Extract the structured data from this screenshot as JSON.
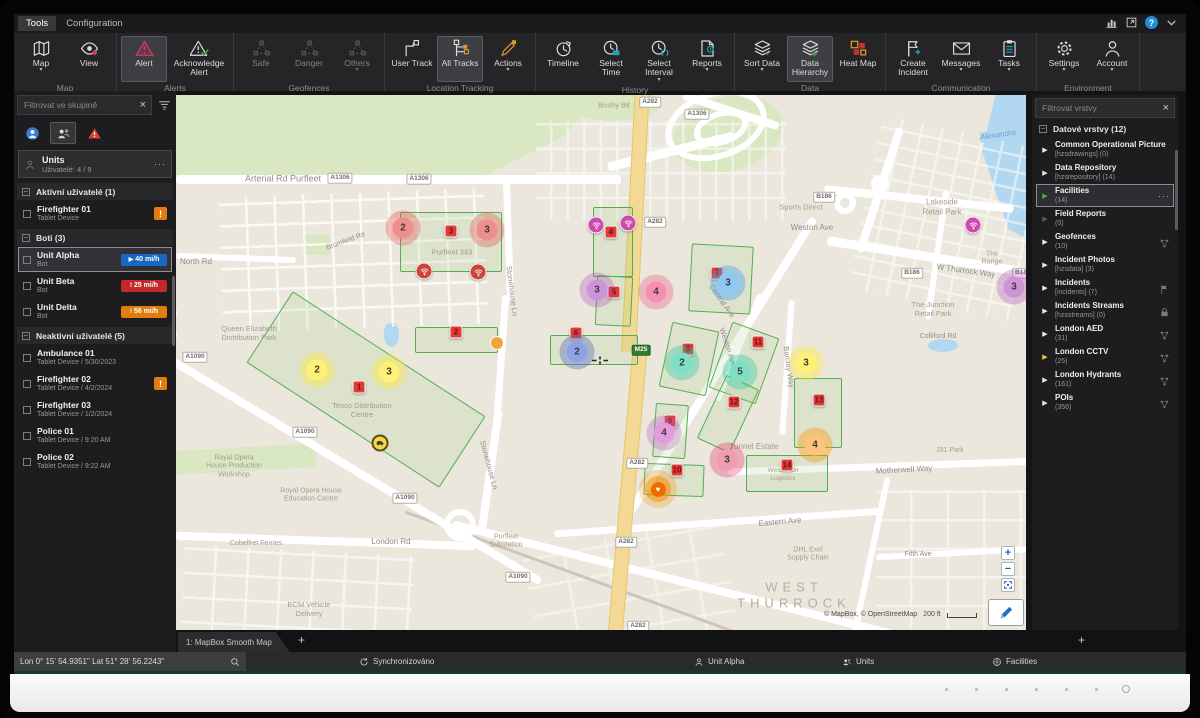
{
  "menubar": {
    "items": [
      {
        "label": "Tools",
        "active": true
      },
      {
        "label": "Configuration",
        "active": false
      }
    ]
  },
  "window_icons": [
    {
      "name": "stats-icon"
    },
    {
      "name": "window-popout-icon"
    },
    {
      "name": "help-icon",
      "glyph": "?"
    },
    {
      "name": "chevron-down-icon"
    }
  ],
  "ribbon": {
    "groups": [
      {
        "label": "Map",
        "buttons": [
          {
            "label": "Map",
            "icon": "map",
            "caret": true
          },
          {
            "label": "View",
            "icon": "view"
          }
        ]
      },
      {
        "label": "Alerts",
        "buttons": [
          {
            "label": "Alert",
            "icon": "alert",
            "active": true
          },
          {
            "label": "Acknowledge Alert",
            "icon": "ack",
            "wide": true
          }
        ]
      },
      {
        "label": "Geofences",
        "buttons": [
          {
            "label": "Safe",
            "icon": "geonet",
            "dim": true
          },
          {
            "label": "Danger",
            "icon": "geonet",
            "dim": true
          },
          {
            "label": "Others",
            "icon": "geonet",
            "dim": true,
            "caret": true
          }
        ]
      },
      {
        "label": "Location Tracking",
        "buttons": [
          {
            "label": "User Track",
            "icon": "usertrack"
          },
          {
            "label": "All Tracks",
            "icon": "alltracks",
            "active": true
          },
          {
            "label": "Actions",
            "icon": "actions",
            "caret": true
          }
        ]
      },
      {
        "label": "History",
        "buttons": [
          {
            "label": "Timeline",
            "icon": "timeline"
          },
          {
            "label": "Select Time",
            "icon": "selecttime"
          },
          {
            "label": "Select Interval",
            "icon": "selectinterval",
            "caret": true
          },
          {
            "label": "Reports",
            "icon": "reports",
            "caret": true
          }
        ]
      },
      {
        "label": "Data",
        "buttons": [
          {
            "label": "Sort Data",
            "icon": "sortdata",
            "caret": true
          },
          {
            "label": "Data Hierarchy",
            "icon": "hierarchy",
            "active": true
          },
          {
            "label": "Heat Map",
            "icon": "heatmap"
          }
        ]
      },
      {
        "label": "Communication",
        "buttons": [
          {
            "label": "Create Incident",
            "icon": "incident"
          },
          {
            "label": "Messages",
            "icon": "messages",
            "caret": true
          },
          {
            "label": "Tasks",
            "icon": "tasks",
            "caret": true
          }
        ]
      },
      {
        "label": "Environment",
        "buttons": [
          {
            "label": "Settings",
            "icon": "settings",
            "caret": true
          },
          {
            "label": "Account",
            "icon": "account",
            "caret": true
          }
        ]
      }
    ]
  },
  "left_panel": {
    "filter_placeholder": "Filtrovat ve skupině",
    "group_card": {
      "title": "Units",
      "subtitle": "Uživatelé: 4 / 9",
      "menu": "···"
    },
    "sections": [
      {
        "label": "Aktivní uživatelé (1)",
        "rows": [
          {
            "name": "Firefighter 01",
            "sub": "Tablet Device",
            "badge": "warn"
          }
        ]
      },
      {
        "label": "Boti (3)",
        "rows": [
          {
            "name": "Unit Alpha",
            "sub": "Bot",
            "badge": "speed-blue",
            "badge_text": "40 mi/h",
            "selected": true
          },
          {
            "name": "Unit Beta",
            "sub": "Bot",
            "badge": "speed-red",
            "badge_text": "25 mi/h"
          },
          {
            "name": "Unit Delta",
            "sub": "Bot",
            "badge": "speed-orange",
            "badge_text": "56 mi/h"
          }
        ]
      },
      {
        "label": "Neaktivní uživatelé (5)",
        "rows": [
          {
            "name": "Ambulance 01",
            "sub": "Tablet Device / 5/30/2023"
          },
          {
            "name": "Firefighter 02",
            "sub": "Tablet Device / 4/2/2024",
            "badge": "warn"
          },
          {
            "name": "Firefighter 03",
            "sub": "Tablet Device / 1/2/2024"
          },
          {
            "name": "Police 01",
            "sub": "Tablet Device / 9:20 AM"
          },
          {
            "name": "Police 02",
            "sub": "Tablet Device / 9:22 AM"
          }
        ]
      }
    ]
  },
  "right_panel": {
    "filter_placeholder": "Filtrovat vrstvy",
    "header": "Datové vrstvy (12)",
    "menu": "···",
    "layers": [
      {
        "name": "Common Operational Picture",
        "sub": "[hzsdrawings] (0)",
        "arrow": "white"
      },
      {
        "name": "Data Repository",
        "sub": "[hzsrepository] (14)",
        "arrow": "white"
      },
      {
        "name": "Facilities",
        "sub": "(14)",
        "arrow": "green",
        "selected": true
      },
      {
        "name": "Field Reports",
        "sub": "(0)",
        "arrow": "dim"
      },
      {
        "name": "Geofences",
        "sub": "(10)",
        "arrow": "white",
        "right_icon": "network"
      },
      {
        "name": "Incident Photos",
        "sub": "[hzsdata] (3)",
        "arrow": "white"
      },
      {
        "name": "Incidents",
        "sub": "[incidents] (7)",
        "arrow": "white",
        "right_icon": "flag"
      },
      {
        "name": "Incidents Streams",
        "sub": "[hzsstreams] (0)",
        "arrow": "white",
        "right_icon": "lock"
      },
      {
        "name": "London AED",
        "sub": "(31)",
        "arrow": "white",
        "right_icon": "network"
      },
      {
        "name": "London CCTV",
        "sub": "(25)",
        "arrow": "yellow",
        "right_icon": "network"
      },
      {
        "name": "London Hydrants",
        "sub": "(161)",
        "arrow": "white",
        "right_icon": "network"
      },
      {
        "name": "POIs",
        "sub": "(356)",
        "arrow": "white",
        "right_icon": "network"
      }
    ]
  },
  "map": {
    "tab": "1: MapBox Smooth Map",
    "attribution": "© MapBox, © OpenStreetMap",
    "scale_label": "200 ft",
    "geofences": [
      {
        "x": 224,
        "y": 117,
        "w": 102,
        "h": 60,
        "r": 0
      },
      {
        "x": 75,
        "y": 252,
        "w": 230,
        "h": 85,
        "r": 33
      },
      {
        "x": 239,
        "y": 232,
        "w": 83,
        "h": 26,
        "r": 0
      },
      {
        "x": 417,
        "y": 112,
        "w": 40,
        "h": 70,
        "r": 0
      },
      {
        "x": 420,
        "y": 181,
        "w": 36,
        "h": 50,
        "r": 3
      },
      {
        "x": 374,
        "y": 240,
        "w": 88,
        "h": 30,
        "r": 0
      },
      {
        "x": 514,
        "y": 150,
        "w": 62,
        "h": 68,
        "r": 3
      },
      {
        "x": 489,
        "y": 231,
        "w": 48,
        "h": 66,
        "r": 12
      },
      {
        "x": 543,
        "y": 233,
        "w": 50,
        "h": 70,
        "r": 20
      },
      {
        "x": 618,
        "y": 283,
        "w": 48,
        "h": 70,
        "r": 0
      },
      {
        "x": 478,
        "y": 309,
        "w": 33,
        "h": 54,
        "r": 4
      },
      {
        "x": 534,
        "y": 284,
        "w": 36,
        "h": 70,
        "r": 25
      },
      {
        "x": 468,
        "y": 369,
        "w": 60,
        "h": 32,
        "r": 2
      },
      {
        "x": 570,
        "y": 360,
        "w": 82,
        "h": 37,
        "r": 0
      }
    ],
    "labels": [
      {
        "t": "Arterial Rd Purfleet",
        "x": 107,
        "y": 84,
        "cls": "road",
        "sz": 9
      },
      {
        "t": "North Rd",
        "x": 20,
        "y": 167,
        "cls": "road",
        "sz": 8
      },
      {
        "t": "Brumfield Rd",
        "x": 170,
        "y": 147,
        "cls": "road",
        "sz": 7,
        "rot": -20
      },
      {
        "t": "Queen Elizabeth\nDistribution Park",
        "x": 73,
        "y": 238,
        "cls": "place"
      },
      {
        "t": "Stonehouse Ln",
        "x": 336,
        "y": 196,
        "cls": "road",
        "sz": 7.5,
        "rot": 83
      },
      {
        "t": "Stonehouse Ln",
        "x": 313,
        "y": 370,
        "cls": "road",
        "sz": 7.5,
        "rot": 75
      },
      {
        "t": "Purfleet 343",
        "x": 276,
        "y": 157,
        "cls": "place",
        "sz": 7.5
      },
      {
        "t": "Tesco Distribution\nCentre",
        "x": 186,
        "y": 315,
        "cls": "place",
        "sz": 7.5
      },
      {
        "t": "London Rd",
        "x": 215,
        "y": 447,
        "cls": "road",
        "sz": 8
      },
      {
        "t": "Royal Opera\nHouse Production\nWorkshop",
        "x": 58,
        "y": 372,
        "cls": "place",
        "sz": 7
      },
      {
        "t": "Royal Opera House\nEducation Centre",
        "x": 135,
        "y": 401,
        "cls": "place",
        "sz": 7
      },
      {
        "t": "Cobelfret Ferries",
        "x": 80,
        "y": 449,
        "cls": "place",
        "sz": 7
      },
      {
        "t": "ECM Vehicle\nDelivery",
        "x": 133,
        "y": 514,
        "cls": "place",
        "sz": 7.5
      },
      {
        "t": "Purfleet\nSubstation",
        "x": 330,
        "y": 447,
        "cls": "place",
        "sz": 7
      },
      {
        "t": "Bushy Bit",
        "x": 438,
        "y": 10,
        "cls": "place",
        "sz": 7.5
      },
      {
        "t": "Sports Direct",
        "x": 625,
        "y": 112,
        "cls": "place",
        "sz": 7.5
      },
      {
        "t": "Weston Ave",
        "x": 636,
        "y": 133,
        "cls": "road",
        "sz": 8
      },
      {
        "t": "Lakeside\nRetail Park",
        "x": 766,
        "y": 112,
        "cls": "place",
        "sz": 8
      },
      {
        "t": "The Range",
        "x": 816,
        "y": 164,
        "cls": "place",
        "sz": 7
      },
      {
        "t": "W Thurrock Way",
        "x": 790,
        "y": 176,
        "cls": "road",
        "sz": 8,
        "rot": 8
      },
      {
        "t": "The Junction\nRetail Park",
        "x": 757,
        "y": 214,
        "cls": "place",
        "sz": 7.5
      },
      {
        "t": "Colliford Rd",
        "x": 762,
        "y": 242,
        "cls": "road",
        "sz": 7
      },
      {
        "t": "J31 Park",
        "x": 774,
        "y": 356,
        "cls": "place",
        "sz": 7
      },
      {
        "t": "Motherwell Way",
        "x": 728,
        "y": 375,
        "cls": "road",
        "sz": 8,
        "rot": -3
      },
      {
        "t": "Eastern Ave",
        "x": 604,
        "y": 427,
        "cls": "road",
        "sz": 8,
        "rot": -5
      },
      {
        "t": "Tunnel Estate",
        "x": 578,
        "y": 352,
        "cls": "place",
        "sz": 8
      },
      {
        "t": "DHL Exel\nSupply Chain",
        "x": 632,
        "y": 460,
        "cls": "place",
        "sz": 7
      },
      {
        "t": "Fifth Ave",
        "x": 742,
        "y": 460,
        "cls": "road",
        "sz": 7
      },
      {
        "t": "WEST\nTHURROCK",
        "x": 618,
        "y": 500,
        "cls": "big"
      },
      {
        "t": "Alexandra",
        "x": 822,
        "y": 40,
        "cls": "water",
        "rot": -8
      },
      {
        "t": "Weston Ave",
        "x": 552,
        "y": 252,
        "cls": "road",
        "sz": 7.5,
        "rot": 72
      },
      {
        "t": "Central Ave",
        "x": 546,
        "y": 206,
        "cls": "road",
        "sz": 7.5,
        "rot": 55
      },
      {
        "t": "Barclay Way",
        "x": 613,
        "y": 272,
        "cls": "road",
        "sz": 7.5,
        "rot": 82
      },
      {
        "t": "Wincanton\nLogistics",
        "x": 607,
        "y": 380,
        "cls": "place",
        "sz": 6.5
      }
    ],
    "shields": [
      {
        "t": "A1306",
        "x": 164,
        "y": 83
      },
      {
        "t": "A1306",
        "x": 243,
        "y": 84
      },
      {
        "t": "A1306",
        "x": 521,
        "y": 19
      },
      {
        "t": "A282",
        "x": 474,
        "y": 7
      },
      {
        "t": "A282",
        "x": 479,
        "y": 127
      },
      {
        "t": "A282",
        "x": 461,
        "y": 368
      },
      {
        "t": "A282",
        "x": 450,
        "y": 447
      },
      {
        "t": "A282",
        "x": 462,
        "y": 531
      },
      {
        "t": "A1090",
        "x": 19,
        "y": 262
      },
      {
        "t": "A1090",
        "x": 129,
        "y": 337
      },
      {
        "t": "A1090",
        "x": 229,
        "y": 403
      },
      {
        "t": "A1090",
        "x": 342,
        "y": 482
      },
      {
        "t": "B186",
        "x": 648,
        "y": 102
      },
      {
        "t": "B186",
        "x": 736,
        "y": 178
      },
      {
        "t": "B18",
        "x": 845,
        "y": 178
      },
      {
        "t": "M25",
        "x": 465,
        "y": 255,
        "g": 1
      }
    ],
    "markers": {
      "squares": [
        {
          "n": "3",
          "x": 275,
          "y": 136
        },
        {
          "n": "1",
          "x": 183,
          "y": 292
        },
        {
          "n": "2",
          "x": 280,
          "y": 237
        },
        {
          "n": "4",
          "x": 435,
          "y": 137
        },
        {
          "n": "5",
          "x": 438,
          "y": 197
        },
        {
          "n": "6",
          "x": 400,
          "y": 238
        },
        {
          "n": "7",
          "x": 541,
          "y": 178
        },
        {
          "n": "8",
          "x": 512,
          "y": 254
        },
        {
          "n": "9",
          "x": 494,
          "y": 326
        },
        {
          "n": "10",
          "x": 501,
          "y": 375
        },
        {
          "n": "11",
          "x": 582,
          "y": 247
        },
        {
          "n": "12",
          "x": 558,
          "y": 307
        },
        {
          "n": "13",
          "x": 643,
          "y": 305
        },
        {
          "n": "14",
          "x": 611,
          "y": 370
        }
      ],
      "circles": [
        {
          "n": "2",
          "x": 227,
          "y": 133,
          "c": "red"
        },
        {
          "n": "3",
          "x": 311,
          "y": 135,
          "c": "red"
        },
        {
          "n": "2",
          "x": 141,
          "y": 275,
          "c": "yellow"
        },
        {
          "n": "3",
          "x": 213,
          "y": 277,
          "c": "yellow"
        },
        {
          "n": "3",
          "x": 421,
          "y": 195,
          "c": "purple"
        },
        {
          "n": "4",
          "x": 480,
          "y": 197,
          "c": "pink"
        },
        {
          "n": "2",
          "x": 401,
          "y": 257,
          "c": "indigo"
        },
        {
          "n": "3",
          "x": 552,
          "y": 188,
          "c": "sky"
        },
        {
          "n": "2",
          "x": 506,
          "y": 268,
          "c": "teal"
        },
        {
          "n": "5",
          "x": 564,
          "y": 277,
          "c": "teal"
        },
        {
          "n": "3",
          "x": 630,
          "y": 268,
          "c": "yellow"
        },
        {
          "n": "4",
          "x": 639,
          "y": 350,
          "c": "orange"
        },
        {
          "n": "4",
          "x": 488,
          "y": 338,
          "c": "violet"
        },
        {
          "n": "3",
          "x": 551,
          "y": 365,
          "c": "rose"
        },
        {
          "n": "3",
          "x": 838,
          "y": 192,
          "c": "purple"
        }
      ],
      "wifi": [
        {
          "x": 248,
          "y": 176,
          "c": "red"
        },
        {
          "x": 302,
          "y": 177,
          "c": "red"
        },
        {
          "x": 420,
          "y": 130,
          "c": "pink"
        },
        {
          "x": 452,
          "y": 128,
          "c": "pink"
        },
        {
          "x": 797,
          "y": 130,
          "c": "pink"
        }
      ],
      "dots": [
        {
          "x": 321,
          "y": 248,
          "c": "#f0a339"
        }
      ],
      "edge": [
        {
          "x": -6,
          "y": 218,
          "c": "#8ea2e8"
        },
        {
          "x": -6,
          "y": 240,
          "c": "#f0a339"
        }
      ],
      "target": {
        "x": 482,
        "y": 394,
        "glyph": "♥"
      },
      "vehicle": {
        "x": 204,
        "y": 348
      }
    },
    "cursor": {
      "x": 424,
      "y": 268
    },
    "controls": {
      "zoom_in": "+",
      "zoom_out": "−"
    }
  },
  "status_bar": {
    "coordinates": "Lon 0° 15' 54.9351\" Lat 51° 28' 56.2243\"",
    "sync": "Synchronizováno",
    "selected_unit": "Unit Alpha",
    "units": "Units",
    "facilities": "Facilities"
  }
}
